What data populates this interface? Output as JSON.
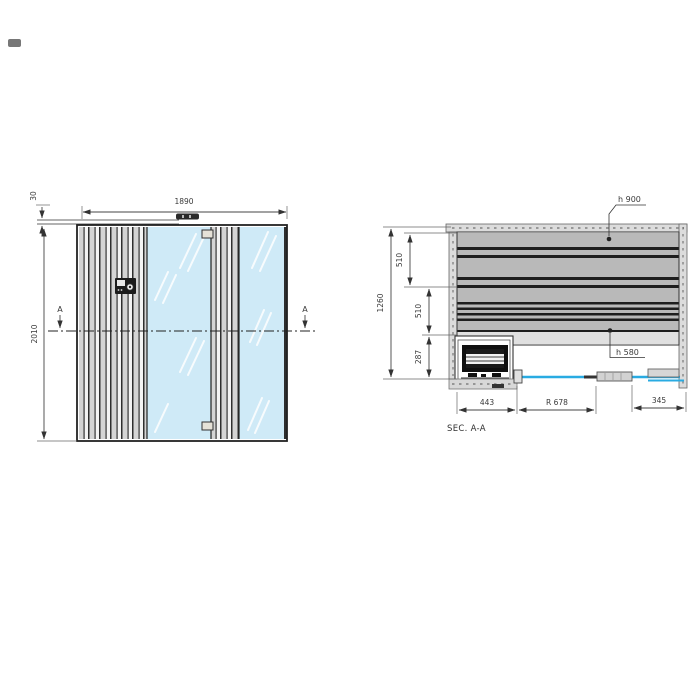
{
  "drawing": {
    "front_view": {
      "dim_width": "1890",
      "dim_height": "2010",
      "dim_roof": "30",
      "section_marker_left": "A",
      "section_marker_right": "A",
      "bottom_note": "L 890"
    },
    "section_view": {
      "title": "SEC. A-A",
      "dim_total_depth": "1260",
      "dim_bench_upper": "510",
      "dim_bench_mid": "510",
      "dim_bench_lower": "287",
      "dim_heater_zone": "443",
      "dim_door_radius": "R 678",
      "dim_side_panel": "345",
      "label_bench_high": "h 900",
      "label_bench_low": "h 580"
    },
    "colors": {
      "glass_fill": "#cfeaf7",
      "glass_line": "#29abe2",
      "bench_fill": "#b9b9b9",
      "wall_fill": "#dcdcdc",
      "line_color": "#333333"
    }
  }
}
